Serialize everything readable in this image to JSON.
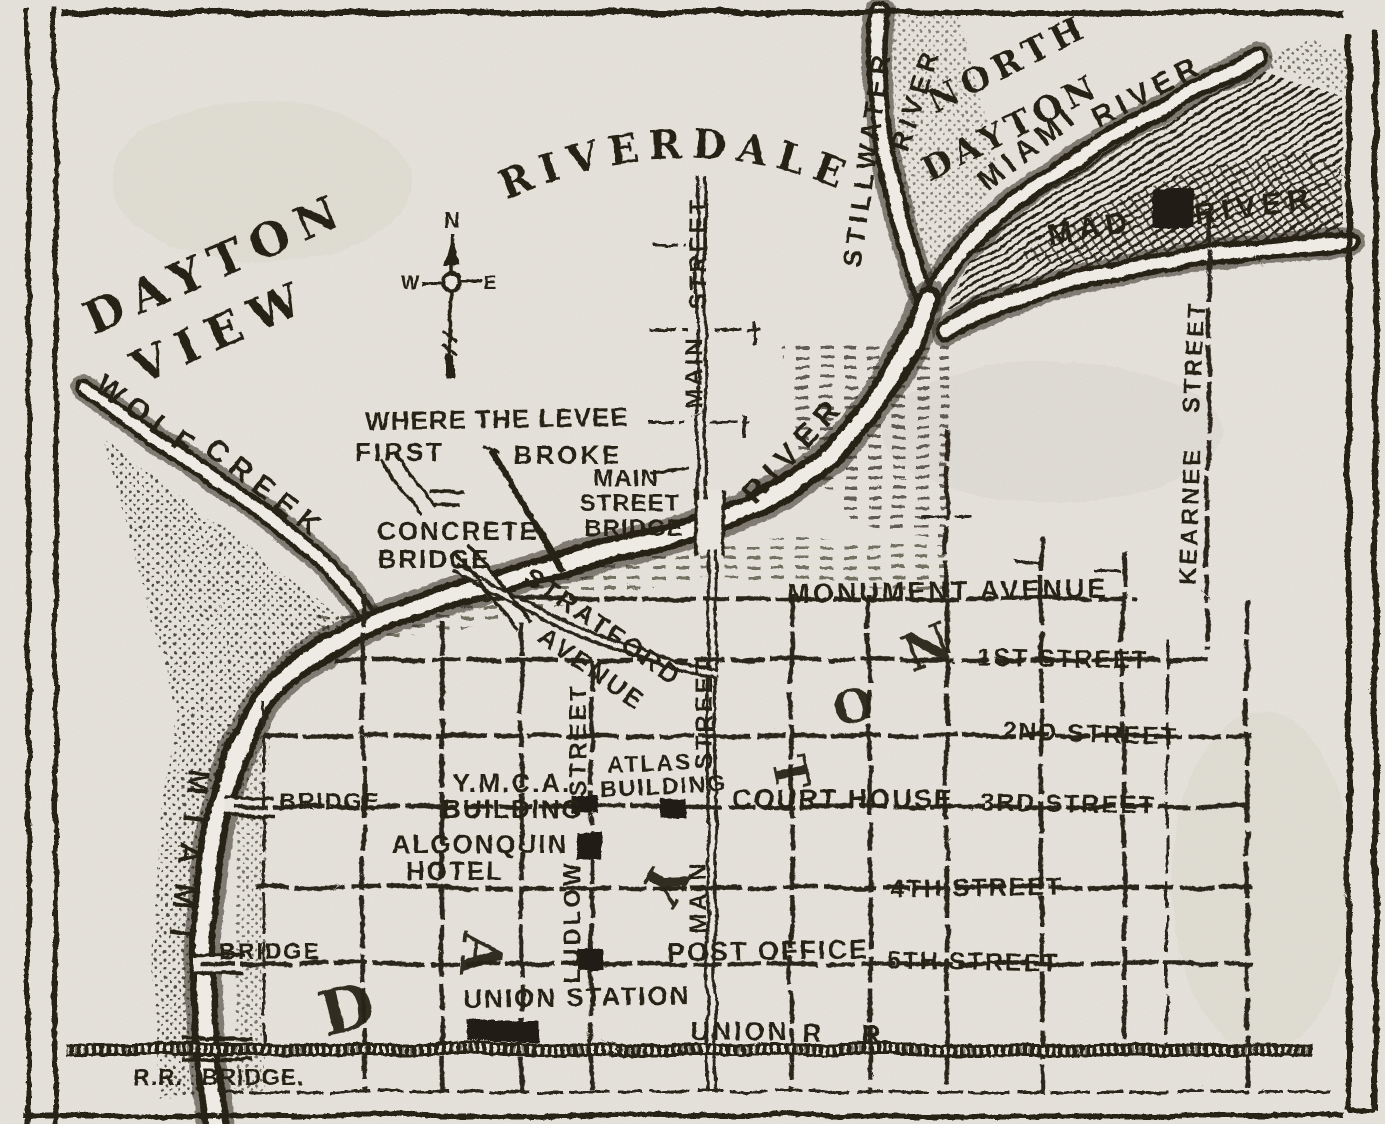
{
  "colors": {
    "paper": "#e8e5de",
    "ink": "#282419",
    "water": "#edebe4"
  },
  "map": {
    "compass": {
      "north": "N",
      "west": "W",
      "east": "E"
    },
    "region_labels": [
      {
        "id": "region-dayton-view-1",
        "text": "DAYTON",
        "x": 222,
        "y": 278,
        "r": -24,
        "s": 46,
        "ls": 10
      },
      {
        "id": "region-dayton-view-2",
        "text": "VIEW",
        "x": 228,
        "y": 346,
        "r": -24,
        "s": 46,
        "ls": 12
      },
      {
        "id": "region-riverdale",
        "text": "RIVERDALE",
        "arc": "#arc-riverdale",
        "tl": 352,
        "s": 40,
        "ls": 10
      },
      {
        "id": "region-north-dayton-1",
        "text": "NORTH",
        "x": 1013,
        "y": 74,
        "r": -27,
        "s": 34,
        "ls": 6
      },
      {
        "id": "region-north-dayton-2",
        "text": "DAYTON",
        "x": 1016,
        "y": 138,
        "r": -27,
        "s": 34,
        "ls": 5
      }
    ],
    "river_labels": [
      {
        "id": "river-stillwater-1",
        "text": "STILLWATER",
        "x": 876,
        "y": 160,
        "r": -82,
        "s": 27,
        "ls": 5
      },
      {
        "id": "river-stillwater-2",
        "text": "RIVER",
        "x": 924,
        "y": 102,
        "r": -72,
        "s": 27,
        "ls": 5
      },
      {
        "id": "river-miami-ne",
        "text": "MIAMI",
        "x": 1034,
        "y": 156,
        "r": -38,
        "s": 30,
        "ls": 6
      },
      {
        "id": "river-miami-ne-2",
        "text": "RIVER",
        "x": 1152,
        "y": 100,
        "r": -28,
        "s": 30,
        "ls": 6
      },
      {
        "id": "river-mad-1",
        "text": "MAD",
        "x": 1092,
        "y": 238,
        "r": -10,
        "s": 30,
        "ls": 6
      },
      {
        "id": "river-mad-2",
        "text": "RIVER",
        "x": 1256,
        "y": 216,
        "r": -8,
        "s": 30,
        "ls": 6
      },
      {
        "id": "river-wolf-1",
        "text": "WOLF",
        "x": 142,
        "y": 425,
        "r": 36,
        "s": 30,
        "ls": 8
      },
      {
        "id": "river-wolf-2",
        "text": "CREEK",
        "x": 260,
        "y": 497,
        "r": 38,
        "s": 30,
        "ls": 8
      },
      {
        "id": "river-miami-sw",
        "text": "MIAMI",
        "x": 178,
        "y": 862,
        "r": 97,
        "s": 30,
        "ls": 20
      },
      {
        "id": "river-main-bend",
        "text": "RIVER",
        "x": 801,
        "y": 456,
        "r": -47,
        "s": 31,
        "ls": 8
      }
    ],
    "street_labels": [
      {
        "id": "street-monument",
        "text": "MONUMENT AVENUE",
        "x": 948,
        "y": 600,
        "r": -1,
        "s": 27,
        "ls": 3
      },
      {
        "id": "street-1st",
        "text": "1ST STREET",
        "x": 1063,
        "y": 667,
        "r": 1,
        "s": 25,
        "ls": 2
      },
      {
        "id": "street-2nd",
        "text": "2ND STREET",
        "x": 1090,
        "y": 742,
        "r": 2,
        "s": 25,
        "ls": 2
      },
      {
        "id": "street-3rd",
        "text": "3RD STREET",
        "x": 1068,
        "y": 812,
        "r": 1,
        "s": 25,
        "ls": 2
      },
      {
        "id": "street-4th",
        "text": "4TH STREET",
        "x": 977,
        "y": 896,
        "r": -1,
        "s": 25,
        "ls": 2
      },
      {
        "id": "street-5th",
        "text": "5TH STREET",
        "x": 973,
        "y": 970,
        "r": 1,
        "s": 25,
        "ls": 2
      },
      {
        "id": "street-main-n-1",
        "text": "STREET",
        "x": 706,
        "y": 253,
        "r": -90,
        "s": 24,
        "ls": 3
      },
      {
        "id": "street-main-n-2",
        "text": "MAIN",
        "x": 702,
        "y": 372,
        "r": -90,
        "s": 24,
        "ls": 3
      },
      {
        "id": "street-main-s-1",
        "text": "STREET",
        "x": 712,
        "y": 713,
        "r": -90,
        "s": 24,
        "ls": 3
      },
      {
        "id": "street-main-s-2",
        "text": "MAIN",
        "x": 706,
        "y": 897,
        "r": -90,
        "s": 24,
        "ls": 3
      },
      {
        "id": "street-ludlow-1",
        "text": "STREET",
        "x": 586,
        "y": 740,
        "r": -90,
        "s": 24,
        "ls": 3
      },
      {
        "id": "street-ludlow-2",
        "text": "LUDLOW",
        "x": 580,
        "y": 922,
        "r": -90,
        "s": 24,
        "ls": 3
      },
      {
        "id": "street-kearnee-1",
        "text": "STREET",
        "x": 1202,
        "y": 357,
        "r": -87,
        "s": 24,
        "ls": 3
      },
      {
        "id": "street-kearnee-2",
        "text": "KEARNEE",
        "x": 1198,
        "y": 516,
        "r": -88,
        "s": 24,
        "ls": 3
      },
      {
        "id": "street-stratford-1",
        "text": "STRATFORD",
        "x": 598,
        "y": 634,
        "r": 35,
        "s": 26,
        "ls": 3
      },
      {
        "id": "street-stratford-2",
        "text": "AVENUE",
        "x": 587,
        "y": 676,
        "r": 35,
        "s": 26,
        "ls": 3
      },
      {
        "id": "street-union-rr-1",
        "text": "UNION",
        "x": 740,
        "y": 1040,
        "r": 0,
        "s": 26,
        "ls": 3
      },
      {
        "id": "street-union-rr-2",
        "text": "R",
        "x": 812,
        "y": 1042,
        "r": 0,
        "s": 26,
        "ls": 0
      },
      {
        "id": "street-union-rr-3",
        "text": "R",
        "x": 871,
        "y": 1043,
        "r": 0,
        "s": 26,
        "ls": 0
      }
    ],
    "place_labels": [
      {
        "id": "place-ymca-1",
        "text": "Y.M.C.A.",
        "x": 512,
        "y": 792,
        "r": 0,
        "s": 26,
        "ls": 2
      },
      {
        "id": "place-ymca-2",
        "text": "BUILDING",
        "x": 513,
        "y": 818,
        "r": 0,
        "s": 26,
        "ls": 2
      },
      {
        "id": "place-atlas-1",
        "text": "ATLAS",
        "x": 650,
        "y": 771,
        "r": -2,
        "s": 23,
        "ls": 2
      },
      {
        "id": "place-atlas-2",
        "text": "BUILDING",
        "x": 664,
        "y": 794,
        "r": -3,
        "s": 23,
        "ls": 2
      },
      {
        "id": "place-court-house",
        "text": "COURT HOUSE",
        "x": 843,
        "y": 808,
        "r": 0,
        "s": 27,
        "ls": 2
      },
      {
        "id": "place-algonquin-1",
        "text": "ALGONQUIN",
        "x": 480,
        "y": 853,
        "r": 0,
        "s": 26,
        "ls": 2
      },
      {
        "id": "place-algonquin-2",
        "text": "HOTEL",
        "x": 455,
        "y": 880,
        "r": 0,
        "s": 26,
        "ls": 2
      },
      {
        "id": "place-post-office",
        "text": "POST OFFICE",
        "x": 768,
        "y": 960,
        "r": -1,
        "s": 27,
        "ls": 2
      },
      {
        "id": "place-union-station",
        "text": "UNION STATION",
        "x": 577,
        "y": 1006,
        "r": -1,
        "s": 26,
        "ls": 2
      }
    ],
    "annotation_labels": [
      {
        "id": "note-levee-1",
        "text": "WHERE THE LEVEE",
        "x": 497,
        "y": 428,
        "r": -1,
        "s": 26,
        "ls": 1
      },
      {
        "id": "note-levee-2",
        "text": "FIRST",
        "x": 400,
        "y": 461,
        "r": 0,
        "s": 26,
        "ls": 3
      },
      {
        "id": "note-levee-3",
        "text": "BROKE",
        "x": 568,
        "y": 464,
        "r": 0,
        "s": 26,
        "ls": 3
      },
      {
        "id": "note-concrete-1",
        "text": "CONCRETE",
        "x": 458,
        "y": 540,
        "r": 0,
        "s": 26,
        "ls": 2
      },
      {
        "id": "note-concrete-2",
        "text": "BRIDGE",
        "x": 434,
        "y": 568,
        "r": 0,
        "s": 26,
        "ls": 2
      },
      {
        "id": "note-main-bridge-1",
        "text": "MAIN",
        "x": 626,
        "y": 486,
        "r": 0,
        "s": 24,
        "ls": 1
      },
      {
        "id": "note-main-bridge-2",
        "text": "STREET",
        "x": 630,
        "y": 511,
        "r": 0,
        "s": 24,
        "ls": 1
      },
      {
        "id": "note-main-bridge-3",
        "text": "BRIDGE",
        "x": 634,
        "y": 536,
        "r": 0,
        "s": 24,
        "ls": 1
      },
      {
        "id": "note-bridge-3rd",
        "text": "BRIDGE",
        "x": 330,
        "y": 809,
        "r": 0,
        "s": 23,
        "ls": 2
      },
      {
        "id": "note-bridge-5th",
        "text": "BRIDGE",
        "x": 270,
        "y": 959,
        "r": 0,
        "s": 23,
        "ls": 2
      },
      {
        "id": "note-rr-bridge-1",
        "text": "R.R.",
        "x": 158,
        "y": 1085,
        "r": 0,
        "s": 23,
        "ls": 1
      },
      {
        "id": "note-rr-bridge-2",
        "text": "BRIDGE.",
        "x": 253,
        "y": 1085,
        "r": 0,
        "s": 23,
        "ls": 1
      }
    ],
    "big_letters": [
      {
        "id": "big-letter-d",
        "text": "D",
        "x": 352,
        "y": 1030,
        "r": -14,
        "s": 62
      },
      {
        "id": "big-letter-a",
        "text": "A",
        "x": 462,
        "y": 952,
        "r": 96,
        "s": 56
      },
      {
        "id": "big-letter-y",
        "text": "Y",
        "x": 648,
        "y": 874,
        "r": 118,
        "s": 54
      },
      {
        "id": "big-letter-t",
        "text": "T",
        "x": 775,
        "y": 776,
        "r": 78,
        "s": 46
      },
      {
        "id": "big-letter-o",
        "text": "O",
        "x": 857,
        "y": 722,
        "r": -14,
        "s": 46
      },
      {
        "id": "big-letter-n",
        "text": "N",
        "x": 934,
        "y": 664,
        "r": -22,
        "s": 52
      }
    ]
  }
}
